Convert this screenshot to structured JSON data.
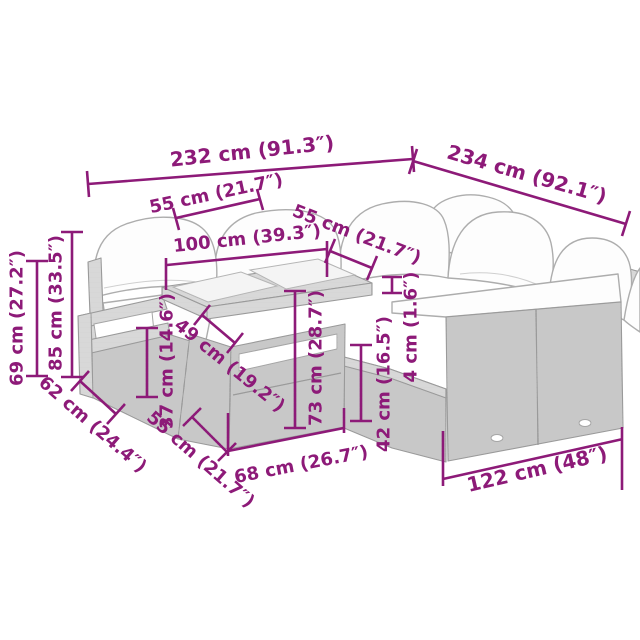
{
  "diagram": {
    "subject": "poly rattan garden lounge set with cushions and glass-top table",
    "colors": {
      "dimension_accent": "#8D1A78",
      "furniture_line": "#9a9a9a",
      "rattan_fill": "#d7d7d7",
      "cushion_fill": "#fdfdfd",
      "background": "#ffffff"
    },
    "dimensions": {
      "total_width_left": "232 cm (91.3″)",
      "total_width_right": "234 cm (92.1″)",
      "backrest_section_width": "55 cm (21.7″)",
      "table_top_width": "100 cm (39.3″)",
      "table_top_depth": "55 cm (21.7″)",
      "armrest_height": "69 cm (27.2″)",
      "total_height": "85 cm (33.5″)",
      "seat_depth_outer": "62 cm (24.4″)",
      "seat_height": "37 cm (14.6″)",
      "seat_depth_inner": "49 cm (19.2″)",
      "seat_width_front": "55 cm (21.7″)",
      "table_height": "73 cm (28.7″)",
      "base_height": "42 cm (16.5″)",
      "tabletop_thickness": "4 cm (1.6″)",
      "table_base_width": "68 cm (26.7″)",
      "sofa_front_width": "122 cm (48″)"
    }
  }
}
